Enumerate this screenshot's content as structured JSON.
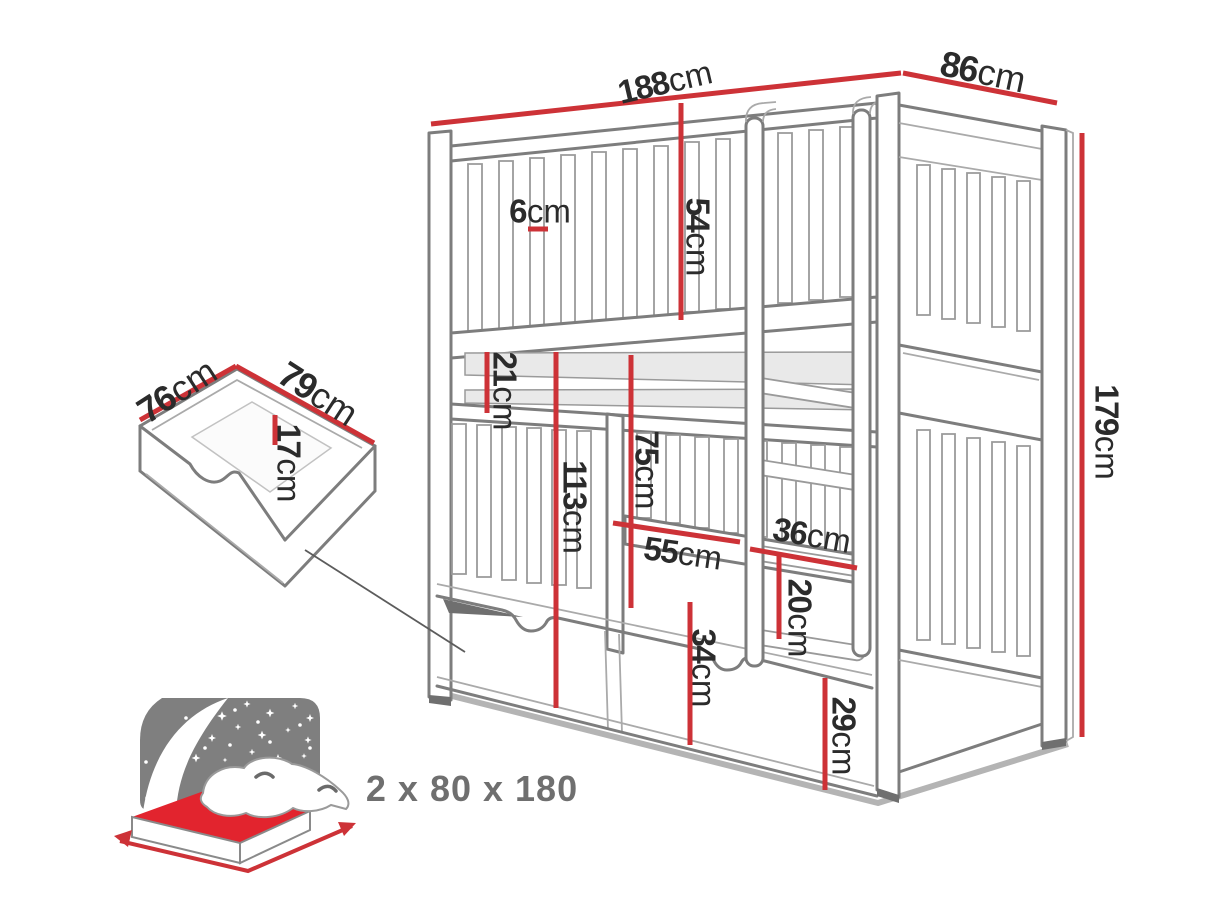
{
  "diagram": {
    "dims": {
      "d188": {
        "v": "188",
        "u": "cm"
      },
      "d86": {
        "v": "86",
        "u": "cm"
      },
      "d179": {
        "v": "179",
        "u": "cm"
      },
      "d6": {
        "v": "6",
        "u": "cm"
      },
      "d54": {
        "v": "54",
        "u": "cm"
      },
      "d21": {
        "v": "21",
        "u": "cm"
      },
      "d113": {
        "v": "113",
        "u": "cm"
      },
      "d75": {
        "v": "75",
        "u": "cm"
      },
      "d55": {
        "v": "55",
        "u": "cm"
      },
      "d36": {
        "v": "36",
        "u": "cm"
      },
      "d20": {
        "v": "20",
        "u": "cm"
      },
      "d34": {
        "v": "34",
        "u": "cm"
      },
      "d29": {
        "v": "29",
        "u": "cm"
      },
      "d76": {
        "v": "76",
        "u": "cm"
      },
      "d79": {
        "v": "79",
        "u": "cm"
      },
      "d17": {
        "v": "17",
        "u": "cm"
      }
    },
    "mattress_note": "2 x 80 x 180",
    "icons": {
      "mattress": "mattress-size-icon",
      "drawer": "drawer-detail-drawing"
    },
    "colors": {
      "dimension_red": "#cd3237",
      "label_text": "#2b2b2b",
      "drawing_gray": "#7d7d7d",
      "drawing_light_gray": "#aaaaaa",
      "icon_gray": "#7f7f7f",
      "mattress_red": "#e2242e",
      "note_text": "#6f6f6f",
      "background": "#ffffff"
    }
  }
}
